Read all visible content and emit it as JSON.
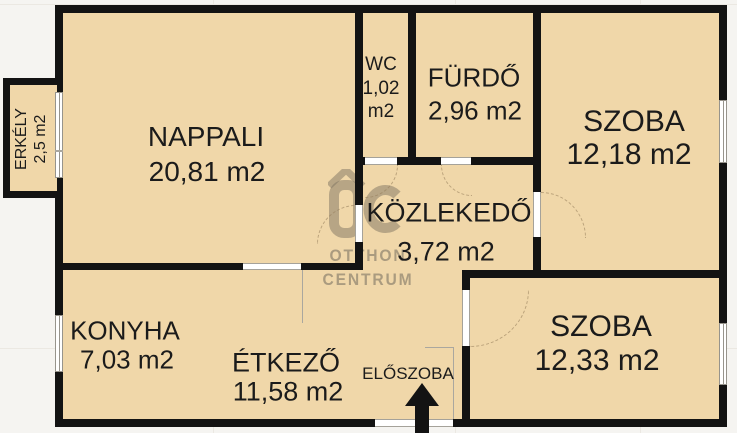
{
  "plan": {
    "watermark": {
      "logo": "OC",
      "line1": "OTTHON",
      "line2": "CENTRUM"
    },
    "rooms": {
      "nappali": {
        "name": "NAPPALI",
        "area": "20,81 m2"
      },
      "wc": {
        "name": "WC",
        "area_line1": "1,02",
        "area_line2": "m2"
      },
      "furdo": {
        "name": "FÜRDŐ",
        "area": "2,96 m2"
      },
      "szoba1": {
        "name": "SZOBA",
        "area": "12,18 m2"
      },
      "kozlekedo": {
        "name": "KÖZLEKEDŐ",
        "area": "3,72 m2"
      },
      "erkely": {
        "name": "ERKÉLY",
        "area": "2,5 m2"
      },
      "konyha": {
        "name": "KONYHA",
        "area": "7,03 m2"
      },
      "etkezo": {
        "name": "ÉTKEZŐ",
        "area": "11,58 m2"
      },
      "eloszoba": {
        "name": "ELŐSZOBA"
      },
      "szoba2": {
        "name": "SZOBA",
        "area": "12,33 m2"
      }
    },
    "colors": {
      "room_fill": "#f0d7a9",
      "wall": "#131313",
      "background": "#f5f4f1",
      "watermark_gray": "#80776a",
      "frame_gray": "#97948c"
    }
  }
}
